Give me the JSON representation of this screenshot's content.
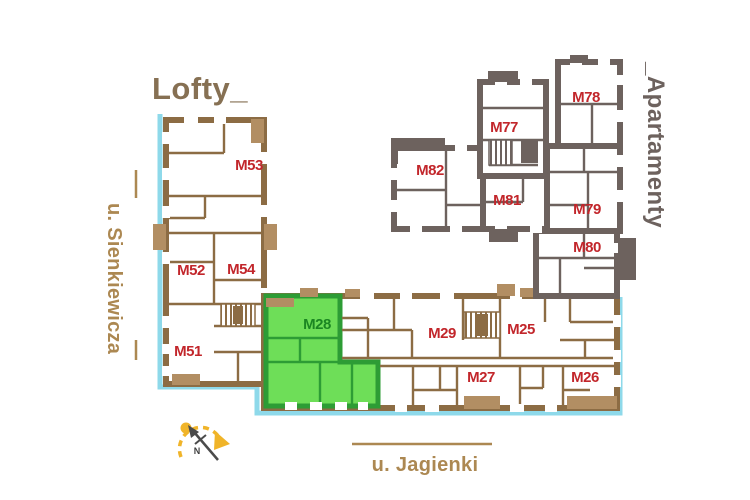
{
  "titles": {
    "lofty": "Lofty_",
    "apartamenty": "_Apartamenty"
  },
  "streets": {
    "left": "u. Sienkiewicza",
    "bottom": "u. Jagienki"
  },
  "compass": {
    "north": "N"
  },
  "highlight": {
    "unit": "M28"
  },
  "units": {
    "lofty": [
      {
        "label": "M53"
      },
      {
        "label": "M52"
      },
      {
        "label": "M54"
      },
      {
        "label": "M51"
      }
    ],
    "wing": [
      {
        "label": "M28",
        "highlighted": true
      },
      {
        "label": "M29"
      },
      {
        "label": "M25"
      },
      {
        "label": "M27"
      },
      {
        "label": "M26"
      }
    ],
    "apartamenty": [
      {
        "label": "M82"
      },
      {
        "label": "M77"
      },
      {
        "label": "M78"
      },
      {
        "label": "M81"
      },
      {
        "label": "M79"
      },
      {
        "label": "M80"
      }
    ]
  },
  "colors": {
    "lofty_walls": "#8c6c44",
    "apartamenty_walls": "#6d625e",
    "balcony_fill": "#b28e63",
    "unit_label_red": "#c2262b",
    "highlight_fill": "#6ede58",
    "highlight_walls": "#2d9c35",
    "highlight_label": "#1b8622",
    "street_line_blue": "#8ed9ea",
    "street_text": "#ac8852",
    "lofty_title_color": "#867053",
    "compass_accent": "#f0b429"
  }
}
